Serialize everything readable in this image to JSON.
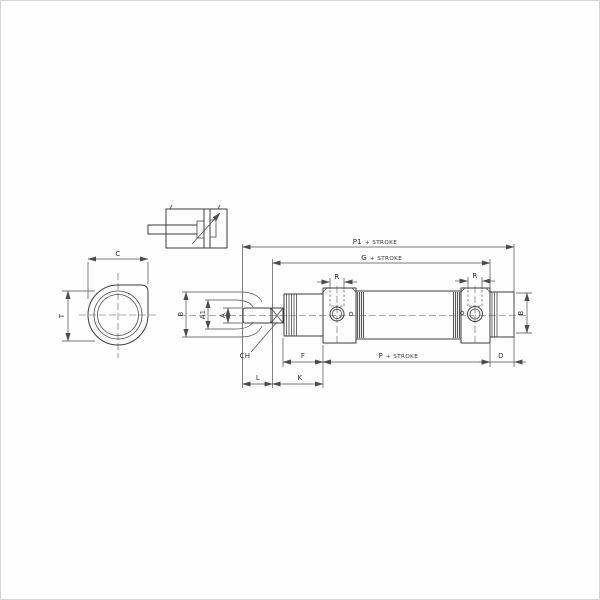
{
  "drawing": {
    "colors": {
      "line": "#3c3c3c",
      "dimension_line": "#4c4c4c",
      "background": "#fffefe",
      "frame": "#d6d6d6"
    },
    "front_view": {
      "dim_width": "C",
      "dim_height": "T"
    },
    "side_view": {
      "dim_p1": {
        "letter": "P1",
        "suffix": "+ STROKE"
      },
      "dim_g": {
        "letter": "G",
        "suffix": "+ STROKE"
      },
      "dim_p": {
        "letter": "P",
        "suffix": "+ STROKE"
      },
      "dim_r_front": "R",
      "dim_r_rear": "R",
      "dim_b_rod": "B",
      "dim_a1": "A1",
      "dim_a": "A",
      "dim_ch": "CH",
      "dim_f": "F",
      "dim_d": "D",
      "dim_l": "L",
      "dim_k": "K",
      "dim_b_rear": "B"
    }
  }
}
